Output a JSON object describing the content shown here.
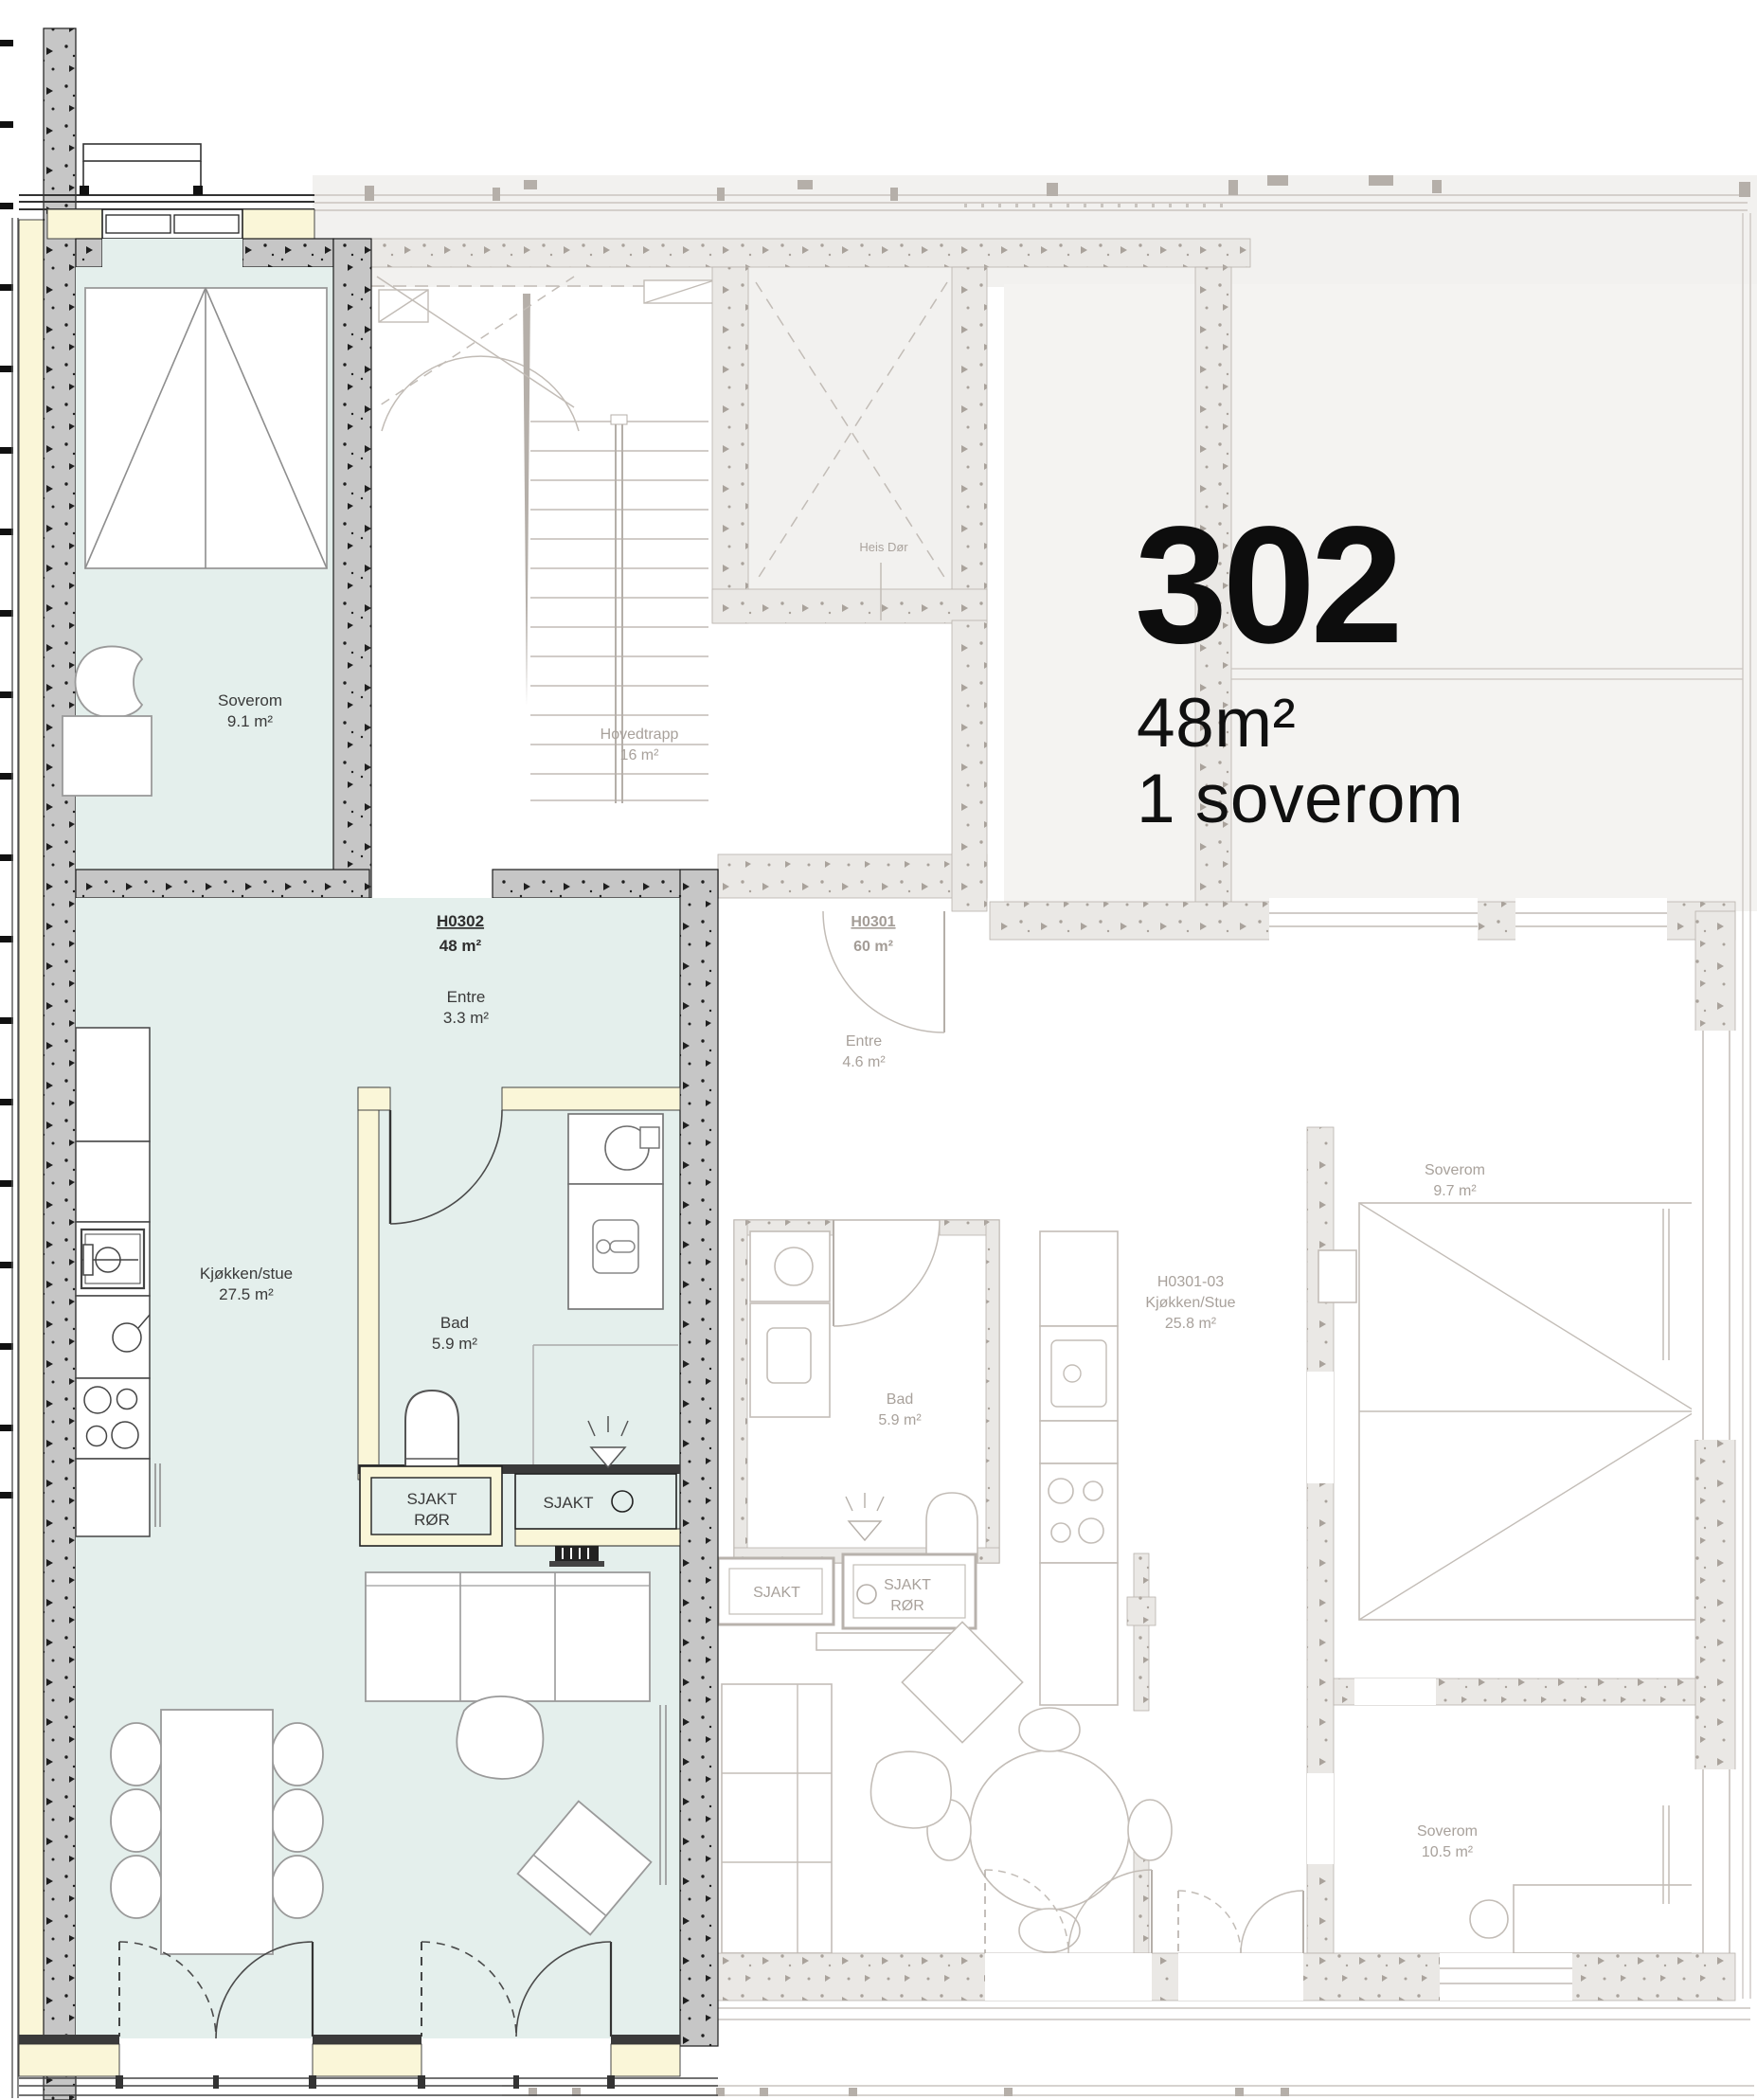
{
  "title": {
    "unit": "302",
    "size": "48m²",
    "bedrooms": "1 soverom"
  },
  "apartment302": {
    "code": "H0302",
    "code_area": "48 m²",
    "soverom": {
      "name": "Soverom",
      "area": "9.1 m²"
    },
    "entre": {
      "name": "Entre",
      "area": "3.3 m²"
    },
    "kjokken_stue": {
      "name": "Kjøkken/stue",
      "area": "27.5 m²"
    },
    "bad": {
      "name": "Bad",
      "area": "5.9 m²"
    },
    "sjakt_ror": {
      "line1": "SJAKT",
      "line2": "RØR"
    },
    "sjakt": {
      "label": "SJAKT"
    }
  },
  "common_areas": {
    "hovedtrapp": {
      "name": "Hovedtrapp",
      "area": "16 m²"
    },
    "heis": {
      "label": "Heis Dør"
    }
  },
  "apartmentH0301": {
    "code": "H0301",
    "code_area": "60 m²",
    "entre": {
      "name": "Entre",
      "area": "4.6 m²"
    },
    "soverom_1": {
      "name": "Soverom",
      "area": "9.7 m²"
    },
    "kjokken_stue": {
      "line1": "H0301-03",
      "line2": "Kjøkken/Stue",
      "line3": "25.8 m²"
    },
    "bad": {
      "name": "Bad",
      "area": "5.9 m²"
    },
    "sjakt": {
      "label": "SJAKT"
    },
    "sjakt_ror": {
      "line1": "SJAKT",
      "line2": "RØR"
    },
    "soverom_2": {
      "name": "Soverom",
      "area": "10.5 m²"
    }
  },
  "colors": {
    "highlight_floor": "#e4efec",
    "insulation": "#faf6d8",
    "concrete_wall": "#c6c6c6",
    "faded_wall": "#eae8e5",
    "faded_line": "#bdb7b1",
    "text_dark": "#3a3a3a",
    "text_muted": "#a8a19b",
    "title_text": "#0d0d0d"
  }
}
